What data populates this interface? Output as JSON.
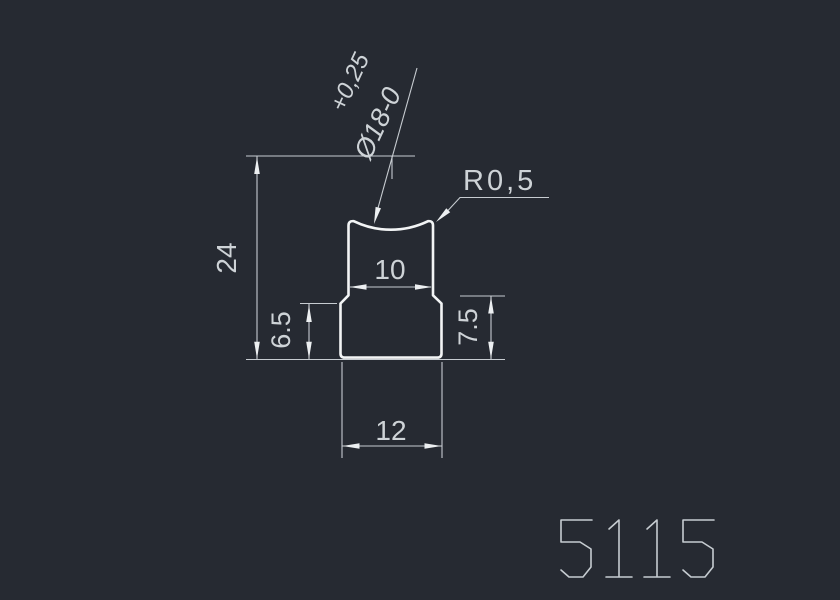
{
  "drawing": {
    "part_number": "5115",
    "labels": {
      "total_height": "24",
      "top_width": "10",
      "bottom_width": "12",
      "left_step_height": "6.5",
      "right_step_height": "7.5",
      "corner_radius": "R0,5",
      "groove_diameter": "Ø18-0",
      "groove_tolerance_upper": "+0,25"
    },
    "colors": {
      "background": "#262a32",
      "object_line": "#f2f4f5",
      "dimension_line": "#c7ccd1",
      "text": "#ced3d7"
    }
  }
}
